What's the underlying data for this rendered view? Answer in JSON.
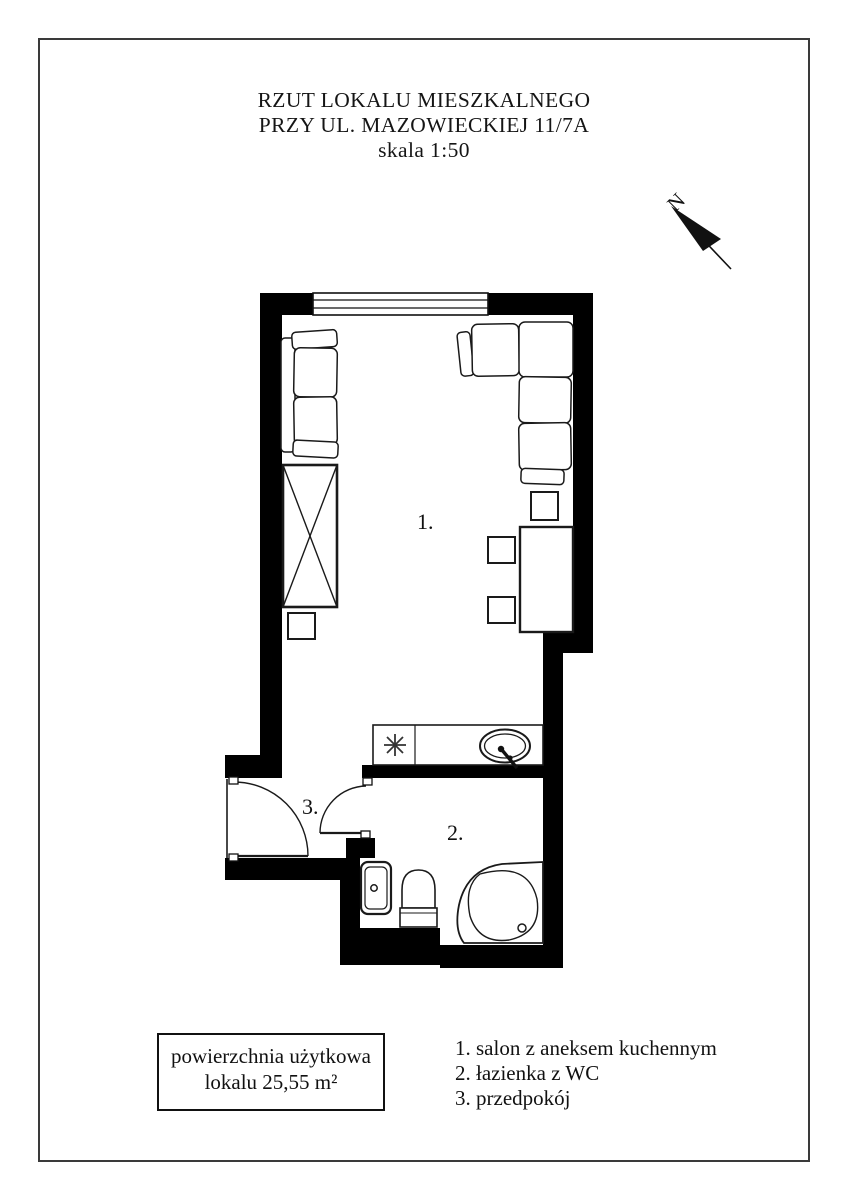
{
  "title": {
    "line1": "RZUT LOKALU MIESZKALNEGO",
    "line2": "PRZY UL. MAZOWIECKIEJ 11/7A",
    "line3": "skala 1:50"
  },
  "north": {
    "label": "N"
  },
  "rooms": {
    "living": {
      "number": "1.",
      "name": "salon z aneksem kuchennym"
    },
    "bathroom": {
      "number": "2.",
      "name": "łazienka z WC"
    },
    "hallway": {
      "number": "3.",
      "name": "przedpokój"
    }
  },
  "area_box": {
    "line1": "powierzchnia użytkowa",
    "line2": "lokalu 25,55 m²"
  },
  "legend": {
    "items": [
      "1. salon z aneksem kuchennym",
      "2. łazienka z WC",
      "3. przedpokój"
    ]
  },
  "colors": {
    "wall": "#000000",
    "line": "#1a1a1a",
    "background": "#ffffff"
  }
}
